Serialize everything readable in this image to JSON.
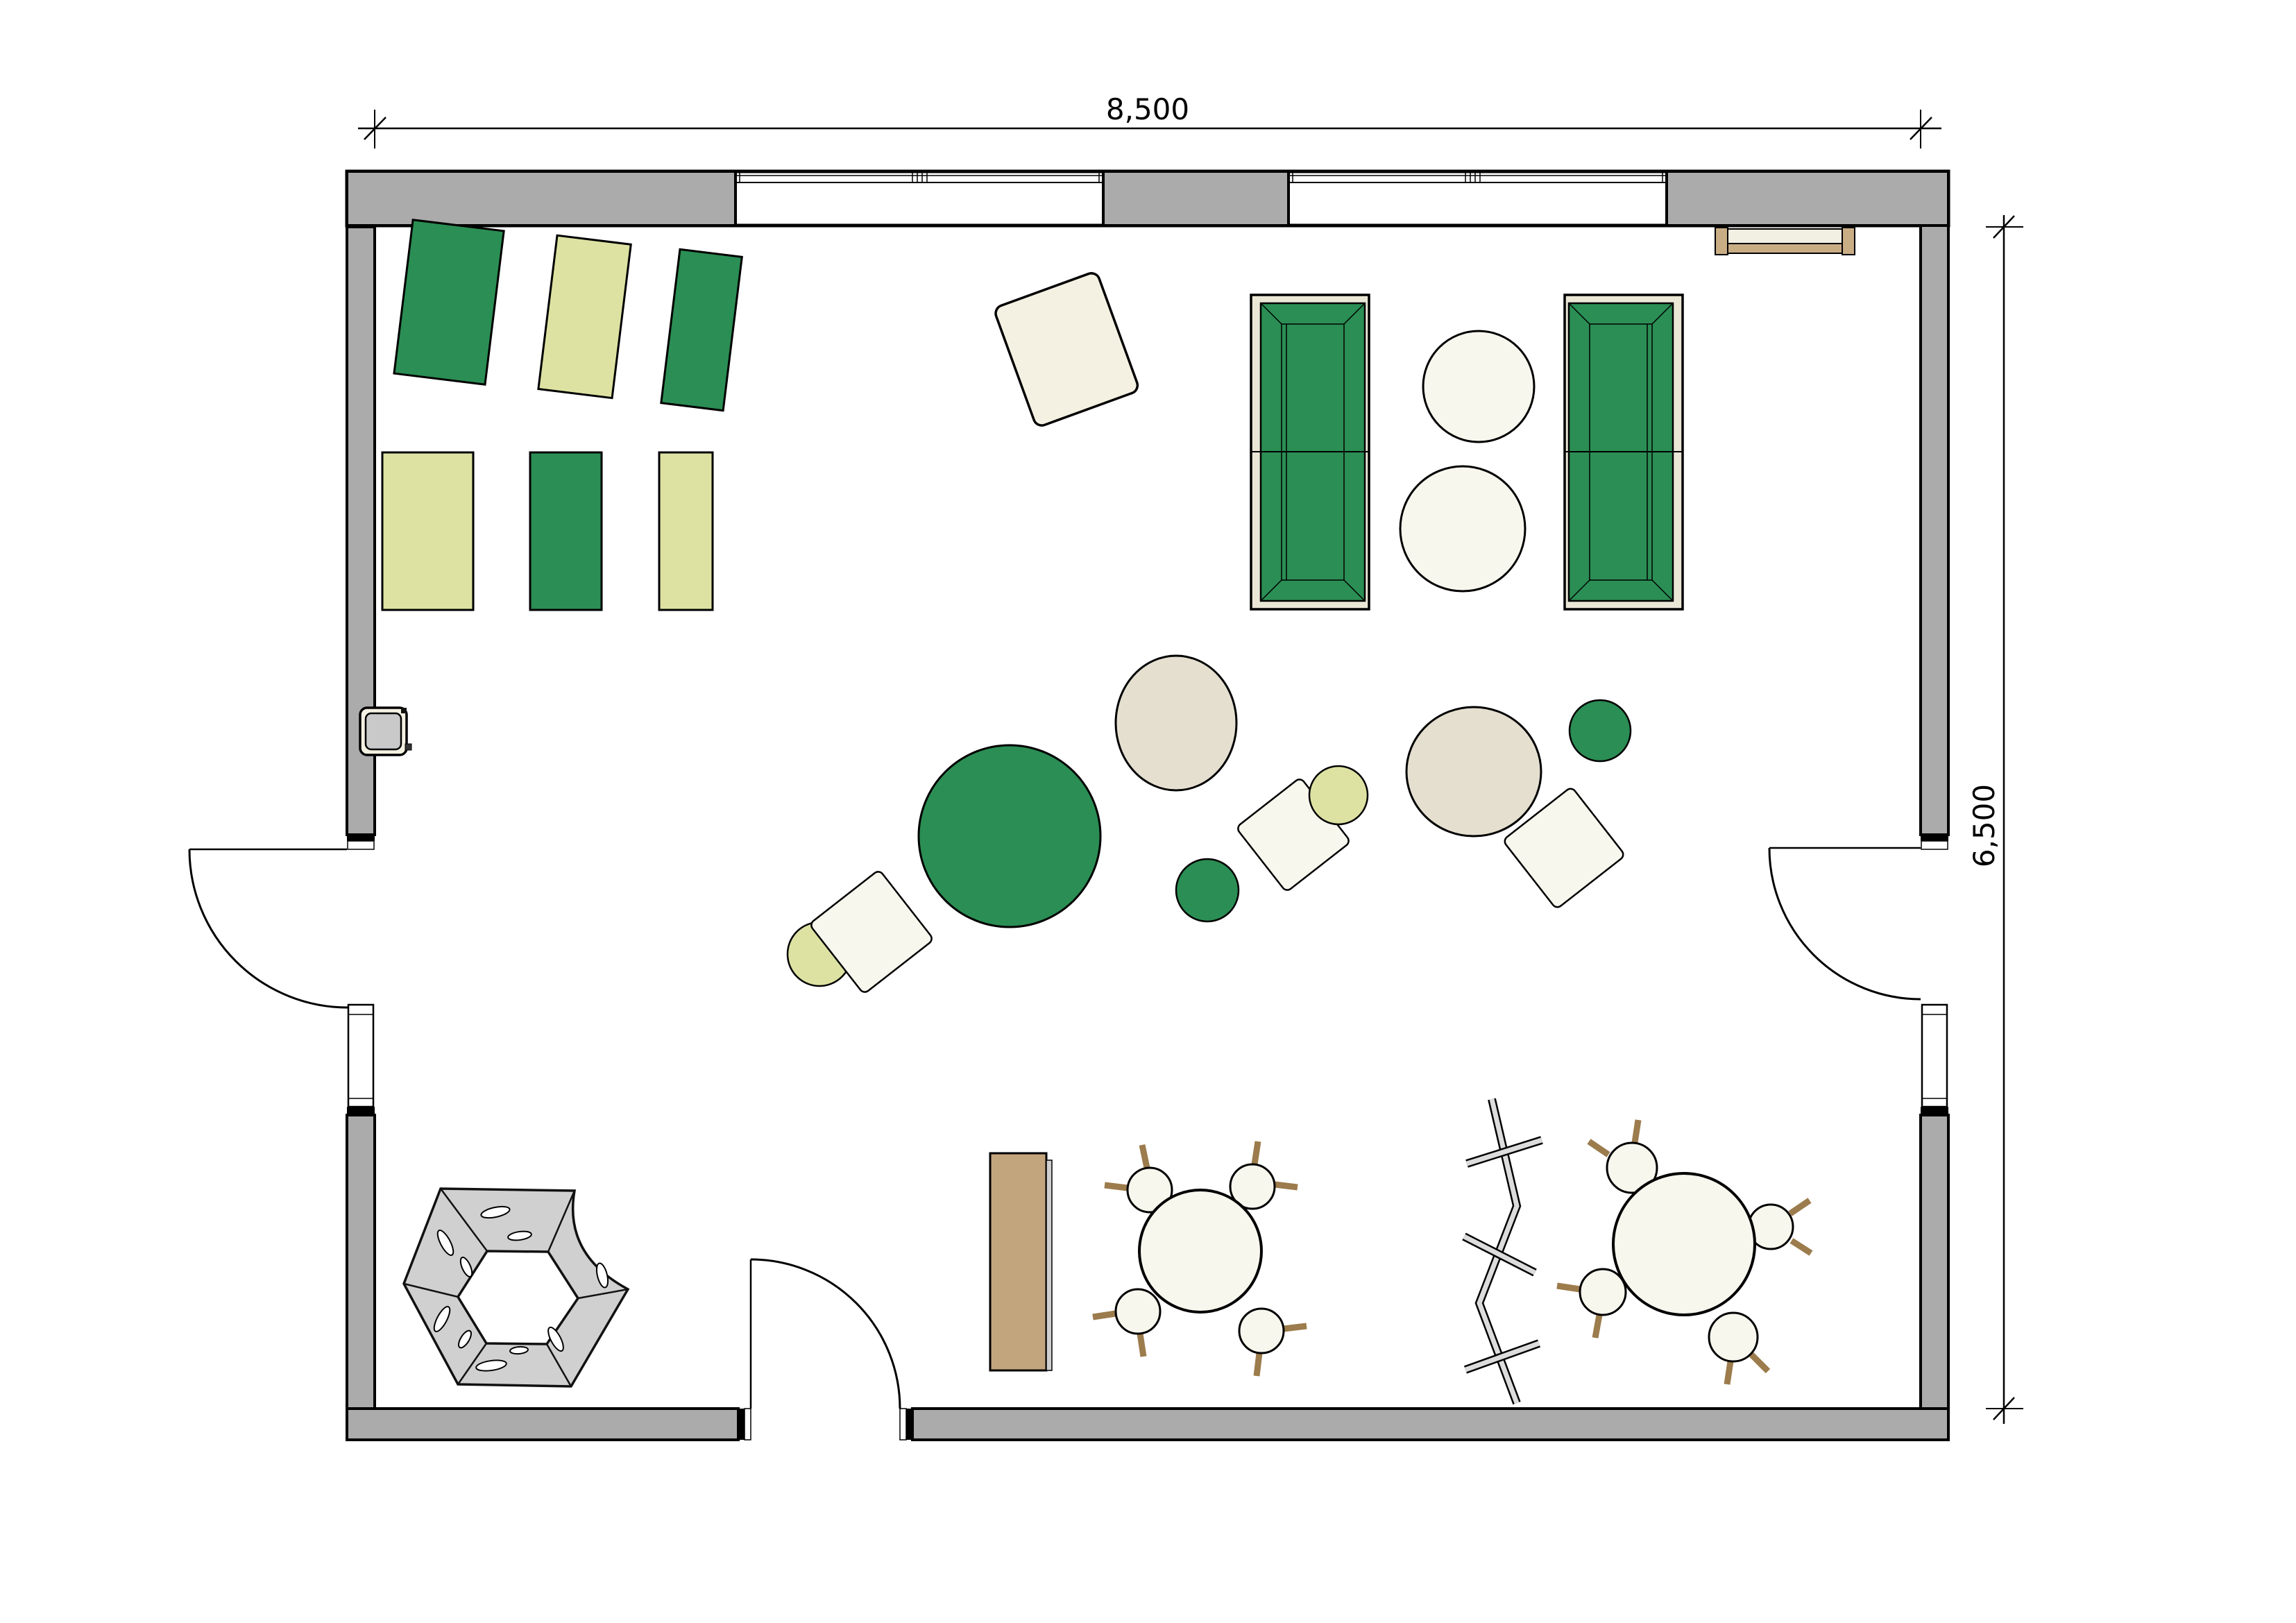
{
  "plan": {
    "title": "kindergarten-group-room-floor-plan",
    "dimension_top": {
      "label": "8,500"
    },
    "dimension_right": {
      "label": "6,500"
    },
    "colors": {
      "wall_gray": "#ababab",
      "green": "#2b8e54",
      "yellow_green": "#dde2a2",
      "cream": "#f8f7ee",
      "cream_dark": "#f4f1e2",
      "beige": "#e5dfd0",
      "sofa_frame": "#ebe7d6",
      "wood_tan": "#c3a57d",
      "wood_light": "#c9ad85",
      "leg_brown": "#a5895e",
      "hex_gray": "#d0d0d0",
      "panel_gray": "#c9c9c9",
      "screen_gray": "#dcdcdc",
      "outline": "#000000"
    },
    "symbols": [
      "exterior-wall",
      "window",
      "door-swing",
      "sleeping-mat-green",
      "sleeping-mat-yellow",
      "play-mat-cream",
      "changing-unit",
      "sofa",
      "side-table",
      "floor-cushion",
      "hexagon-play-structure",
      "cabinet",
      "round-table",
      "chair",
      "folding-screen",
      "wall-bench"
    ]
  }
}
